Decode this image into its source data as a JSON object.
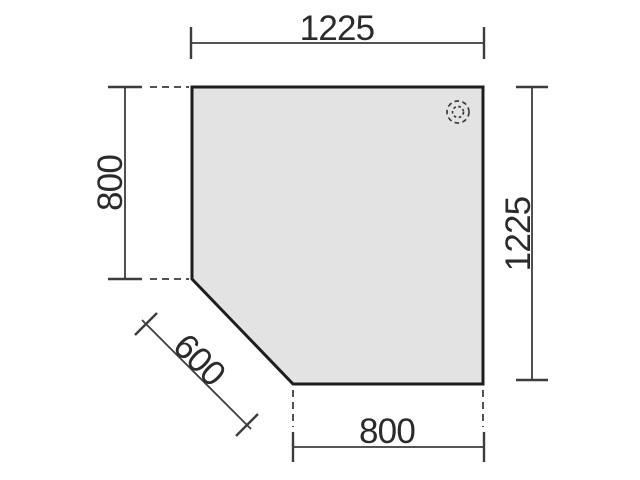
{
  "diagram": {
    "labels": {
      "top_width": "1225",
      "left_height": "800",
      "right_height": "1225",
      "diagonal_edge": "600",
      "bottom_width": "800"
    },
    "icons": {
      "grommet": "cable-grommet-dashed-circle"
    },
    "colors": {
      "background": "#ffffff",
      "surface_fill": "#e3e3e3",
      "surface_outline": "#1e1e1e",
      "dimension_lines": "#3d3d3d",
      "label_text": "#2b2b2b"
    }
  }
}
